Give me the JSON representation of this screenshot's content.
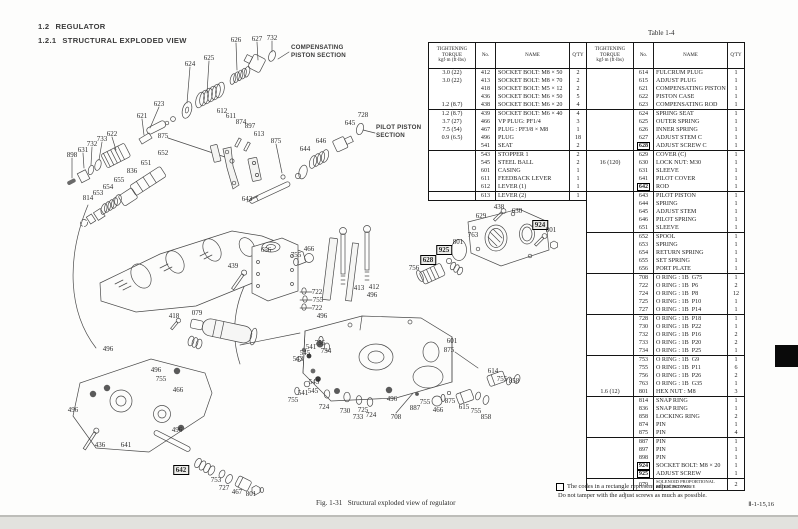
{
  "page": {
    "section_number": "1.2",
    "section_title": "REGULATOR",
    "subsection_number": "1.2.1",
    "subsection_title": "STRUCTURAL EXPLODED VIEW",
    "table_label": "Table 1-4",
    "figure_caption": "Fig. 1-31   Structural exploded view of regulator",
    "footnote_line1": "The codes in a rectangle represent adjust screws.",
    "footnote_line2": "Do not tamper with the adjust screws as much as possible.",
    "page_ref": "Ⅱ-1-15,16"
  },
  "diagram": {
    "section_labels": {
      "compensating": "COMPENSATING\nPISTON SECTION",
      "pilot": "PILOT PISTON\nSECTION"
    },
    "callouts": [
      {
        "t": "624",
        "x": 190,
        "y": 64
      },
      {
        "t": "625",
        "x": 209,
        "y": 58
      },
      {
        "t": "626",
        "x": 236,
        "y": 40
      },
      {
        "t": "627",
        "x": 257,
        "y": 39
      },
      {
        "t": "732",
        "x": 272,
        "y": 38
      },
      {
        "t": "623",
        "x": 159,
        "y": 104
      },
      {
        "t": "621",
        "x": 142,
        "y": 116
      },
      {
        "t": "622",
        "x": 112,
        "y": 134
      },
      {
        "t": "733",
        "x": 102,
        "y": 139
      },
      {
        "t": "732",
        "x": 92,
        "y": 144
      },
      {
        "t": "631",
        "x": 83,
        "y": 150
      },
      {
        "t": "898",
        "x": 72,
        "y": 155
      },
      {
        "t": "875",
        "x": 163,
        "y": 136
      },
      {
        "t": "612",
        "x": 222,
        "y": 111
      },
      {
        "t": "611",
        "x": 231,
        "y": 116
      },
      {
        "t": "874",
        "x": 241,
        "y": 122
      },
      {
        "t": "897",
        "x": 250,
        "y": 126
      },
      {
        "t": "613",
        "x": 259,
        "y": 134
      },
      {
        "t": "875",
        "x": 276,
        "y": 141
      },
      {
        "t": "652",
        "x": 163,
        "y": 153
      },
      {
        "t": "651",
        "x": 146,
        "y": 163
      },
      {
        "t": "836",
        "x": 132,
        "y": 171
      },
      {
        "t": "655",
        "x": 119,
        "y": 180
      },
      {
        "t": "654",
        "x": 108,
        "y": 187
      },
      {
        "t": "653",
        "x": 98,
        "y": 193
      },
      {
        "t": "814",
        "x": 88,
        "y": 198
      },
      {
        "t": "643",
        "x": 247,
        "y": 199
      },
      {
        "t": "644",
        "x": 305,
        "y": 149
      },
      {
        "t": "646",
        "x": 321,
        "y": 141
      },
      {
        "t": "645",
        "x": 350,
        "y": 123
      },
      {
        "t": "728",
        "x": 363,
        "y": 115
      },
      {
        "t": "418",
        "x": 174,
        "y": 316
      },
      {
        "t": "079",
        "x": 197,
        "y": 313
      },
      {
        "t": "496",
        "x": 108,
        "y": 349
      },
      {
        "t": "496",
        "x": 156,
        "y": 370
      },
      {
        "t": "755",
        "x": 161,
        "y": 379
      },
      {
        "t": "466",
        "x": 178,
        "y": 390
      },
      {
        "t": "496",
        "x": 73,
        "y": 410
      },
      {
        "t": "436",
        "x": 100,
        "y": 445
      },
      {
        "t": "641",
        "x": 126,
        "y": 445
      },
      {
        "t": "496",
        "x": 177,
        "y": 430
      },
      {
        "t": "642",
        "x": 181,
        "y": 470,
        "boxed": true
      },
      {
        "t": "753",
        "x": 216,
        "y": 480
      },
      {
        "t": "727",
        "x": 224,
        "y": 488
      },
      {
        "t": "467",
        "x": 237,
        "y": 492
      },
      {
        "t": "801",
        "x": 251,
        "y": 494
      },
      {
        "t": "439",
        "x": 233,
        "y": 266
      },
      {
        "t": "656",
        "x": 266,
        "y": 250
      },
      {
        "t": "755",
        "x": 296,
        "y": 255
      },
      {
        "t": "466",
        "x": 309,
        "y": 249
      },
      {
        "t": "722",
        "x": 317,
        "y": 292
      },
      {
        "t": "755",
        "x": 318,
        "y": 300
      },
      {
        "t": "722",
        "x": 317,
        "y": 308
      },
      {
        "t": "496",
        "x": 322,
        "y": 316
      },
      {
        "t": "413",
        "x": 359,
        "y": 288
      },
      {
        "t": "412",
        "x": 374,
        "y": 287
      },
      {
        "t": "496",
        "x": 372,
        "y": 295
      },
      {
        "t": "756",
        "x": 414,
        "y": 268
      },
      {
        "t": "628",
        "x": 428,
        "y": 260,
        "boxed": true
      },
      {
        "t": "925",
        "x": 444,
        "y": 250,
        "boxed": true
      },
      {
        "t": "755",
        "x": 320,
        "y": 343
      },
      {
        "t": "734",
        "x": 326,
        "y": 351
      },
      {
        "t": "541",
        "x": 311,
        "y": 347
      },
      {
        "t": "545",
        "x": 305,
        "y": 353
      },
      {
        "t": "543",
        "x": 298,
        "y": 359
      },
      {
        "t": "543",
        "x": 314,
        "y": 382
      },
      {
        "t": "545",
        "x": 313,
        "y": 391
      },
      {
        "t": "541",
        "x": 303,
        "y": 393
      },
      {
        "t": "755",
        "x": 293,
        "y": 400
      },
      {
        "t": "724",
        "x": 324,
        "y": 407
      },
      {
        "t": "730",
        "x": 345,
        "y": 411
      },
      {
        "t": "733",
        "x": 358,
        "y": 417
      },
      {
        "t": "725",
        "x": 363,
        "y": 410
      },
      {
        "t": "724",
        "x": 371,
        "y": 415
      },
      {
        "t": "708",
        "x": 396,
        "y": 417
      },
      {
        "t": "496",
        "x": 392,
        "y": 399
      },
      {
        "t": "887",
        "x": 415,
        "y": 408
      },
      {
        "t": "755",
        "x": 425,
        "y": 402
      },
      {
        "t": "466",
        "x": 438,
        "y": 410
      },
      {
        "t": "875",
        "x": 450,
        "y": 401
      },
      {
        "t": "615",
        "x": 464,
        "y": 407
      },
      {
        "t": "755",
        "x": 476,
        "y": 411
      },
      {
        "t": "858",
        "x": 486,
        "y": 417
      },
      {
        "t": "614",
        "x": 493,
        "y": 371
      },
      {
        "t": "755",
        "x": 502,
        "y": 379
      },
      {
        "t": "858",
        "x": 514,
        "y": 381
      },
      {
        "t": "601",
        "x": 452,
        "y": 341
      },
      {
        "t": "875",
        "x": 449,
        "y": 350
      },
      {
        "t": "629",
        "x": 481,
        "y": 216
      },
      {
        "t": "438",
        "x": 499,
        "y": 207
      },
      {
        "t": "630",
        "x": 517,
        "y": 211
      },
      {
        "t": "924",
        "x": 540,
        "y": 225,
        "boxed": true
      },
      {
        "t": "801",
        "x": 551,
        "y": 230
      },
      {
        "t": "763",
        "x": 473,
        "y": 235
      },
      {
        "t": "801",
        "x": 458,
        "y": 242
      }
    ]
  },
  "parts_table": {
    "headers": {
      "torque1": "TIGHTENING",
      "torque2": "TORQUE",
      "torque3": "kgf·m (ft·lbs)",
      "no": "No.",
      "name": "NAME",
      "qty": "Q'TY"
    },
    "left_rows": [
      {
        "tq": "3.0 (22)",
        "no": "412",
        "name": "SOCKET BOLT: M8 × 50",
        "qty": "2"
      },
      {
        "tq": "3.0 (22)",
        "no": "413",
        "name": "SOCKET BOLT: M8 × 70",
        "qty": "2"
      },
      {
        "no": "418",
        "name": "SOCKET BOLT: M5 × 12",
        "qty": "2"
      },
      {
        "no": "436",
        "name": "SOCKET BOLT: M6 × 50",
        "qty": "5"
      },
      {
        "tq": "1.2 (8.7)",
        "no": "438",
        "name": "SOCKET BOLT: M6 × 20",
        "qty": "4"
      },
      {
        "tq": "1.2 (8.7)",
        "no": "439",
        "name": "SOCKET BOLT: M6 × 40",
        "qty": "4",
        "sep": true
      },
      {
        "tq": "3.7 (27)",
        "no": "466",
        "name": "VP PLUG: PF1/4",
        "qty": "3"
      },
      {
        "tq": "7.5 (54)",
        "no": "467",
        "name": "PLUG : PF3/8 × M8",
        "qty": "1"
      },
      {
        "tq": "0.9 (6.5)",
        "no": "496",
        "name": "PLUG",
        "qty": "18"
      },
      {
        "no": "541",
        "name": "SEAT",
        "qty": "2"
      },
      {
        "no": "543",
        "name": "STOPPER 1",
        "qty": "2",
        "sep": true
      },
      {
        "no": "545",
        "name": "STEEL BALL",
        "qty": "2"
      },
      {
        "no": "601",
        "name": "CASING",
        "qty": "1"
      },
      {
        "no": "611",
        "name": "FEEDBACK LEVER",
        "qty": "1"
      },
      {
        "no": "612",
        "name": "LEVER (1)",
        "qty": "1"
      },
      {
        "no": "613",
        "name": "LEVER (2)",
        "qty": "1",
        "sep": true
      }
    ],
    "right_rows": [
      {
        "no": "614",
        "name": "FULCRUM PLUG",
        "qty": "1"
      },
      {
        "no": "615",
        "name": "ADJUST PLUG",
        "qty": "1"
      },
      {
        "no": "621",
        "name": "COMPENSATING PISTON",
        "qty": "1"
      },
      {
        "no": "622",
        "name": "PISTON CASE",
        "qty": "1"
      },
      {
        "no": "623",
        "name": "COMPENSATING ROD",
        "qty": "1"
      },
      {
        "no": "624",
        "name": "SPRING SEAT",
        "qty": "1",
        "sep": true
      },
      {
        "no": "625",
        "name": "OUTER SPRING",
        "qty": "1"
      },
      {
        "no": "626",
        "name": "INNER SPRING",
        "qty": "1"
      },
      {
        "no": "627",
        "name": "ADJUST STEM C",
        "qty": "1"
      },
      {
        "no": "628",
        "name": "ADJUST SCREW C",
        "qty": "1",
        "boxed": true
      },
      {
        "no": "629",
        "name": "COVER (C)",
        "qty": "1",
        "sep": true
      },
      {
        "tq": "16 (120)",
        "no": "630",
        "name": "LOCK NUT: M30",
        "qty": "1"
      },
      {
        "no": "631",
        "name": "SLEEVE",
        "qty": "1"
      },
      {
        "no": "641",
        "name": "PILOT COVER",
        "qty": "1"
      },
      {
        "no": "642",
        "name": "ROD",
        "qty": "1",
        "boxed": true
      },
      {
        "no": "643",
        "name": "PILOT PISTON",
        "qty": "1",
        "sep": true
      },
      {
        "no": "644",
        "name": "SPRING",
        "qty": "1"
      },
      {
        "no": "645",
        "name": "ADJUST STEM",
        "qty": "1"
      },
      {
        "no": "646",
        "name": "PILOT SPRING",
        "qty": "1"
      },
      {
        "no": "651",
        "name": "SLEEVE",
        "qty": "1"
      },
      {
        "no": "652",
        "name": "SPOOL",
        "qty": "1",
        "sep": true
      },
      {
        "no": "653",
        "name": "SPRING",
        "qty": "1"
      },
      {
        "no": "654",
        "name": "RETURN SPRING",
        "qty": "1"
      },
      {
        "no": "655",
        "name": "SET SPRING",
        "qty": "1"
      },
      {
        "no": "656",
        "name": "PORT PLATE",
        "qty": "1"
      },
      {
        "no": "708",
        "name": "O RING : 1B  G75",
        "qty": "1",
        "sep": true
      },
      {
        "no": "722",
        "name": "O RING : 1B  P6",
        "qty": "2"
      },
      {
        "no": "724",
        "name": "O RING : 1B  P8",
        "qty": "12"
      },
      {
        "no": "725",
        "name": "O RING : 1B  P10",
        "qty": "1"
      },
      {
        "no": "727",
        "name": "O RING : 1B  P14",
        "qty": "1"
      },
      {
        "no": "728",
        "name": "O RING : 1B  P18",
        "qty": "1",
        "sep": true
      },
      {
        "no": "730",
        "name": "O RING : 1B  P22",
        "qty": "1"
      },
      {
        "no": "732",
        "name": "O RING : 1B  P16",
        "qty": "2"
      },
      {
        "no": "733",
        "name": "O RING : 1B  P20",
        "qty": "2"
      },
      {
        "no": "734",
        "name": "O RING : 1B  P25",
        "qty": "1"
      },
      {
        "no": "753",
        "name": "O RING : 1B  G9",
        "qty": "1",
        "sep": true
      },
      {
        "no": "755",
        "name": "O RING : 1B  P11",
        "qty": "6"
      },
      {
        "no": "756",
        "name": "O RING : 1B  P26",
        "qty": "2"
      },
      {
        "no": "763",
        "name": "O RING : 1B  G35",
        "qty": "1"
      },
      {
        "tq": "1.6 (12)",
        "no": "801",
        "name": "HEX NUT : M8",
        "qty": "3"
      },
      {
        "no": "814",
        "name": "SNAP RING",
        "qty": "1",
        "sep": true
      },
      {
        "no": "836",
        "name": "SNAP RING",
        "qty": "1"
      },
      {
        "no": "858",
        "name": "LOCKING RING",
        "qty": "2"
      },
      {
        "no": "874",
        "name": "PIN",
        "qty": "1"
      },
      {
        "no": "875",
        "name": "PIN",
        "qty": "4"
      },
      {
        "no": "887",
        "name": "PIN",
        "qty": "1",
        "sep": true
      },
      {
        "no": "897",
        "name": "PIN",
        "qty": "1"
      },
      {
        "no": "898",
        "name": "PIN",
        "qty": "1"
      },
      {
        "no": "924",
        "name": "SOCKET BOLT: M8 × 20",
        "qty": "1",
        "boxed": true
      },
      {
        "no": "925",
        "name": "ADJUST SCREW",
        "qty": "1",
        "boxed": true
      },
      {
        "no": "079",
        "name": "SOLENOID PROPORTIONAL\nREDUCING VALVE",
        "qty": "2",
        "sep": true,
        "small": true
      }
    ]
  }
}
